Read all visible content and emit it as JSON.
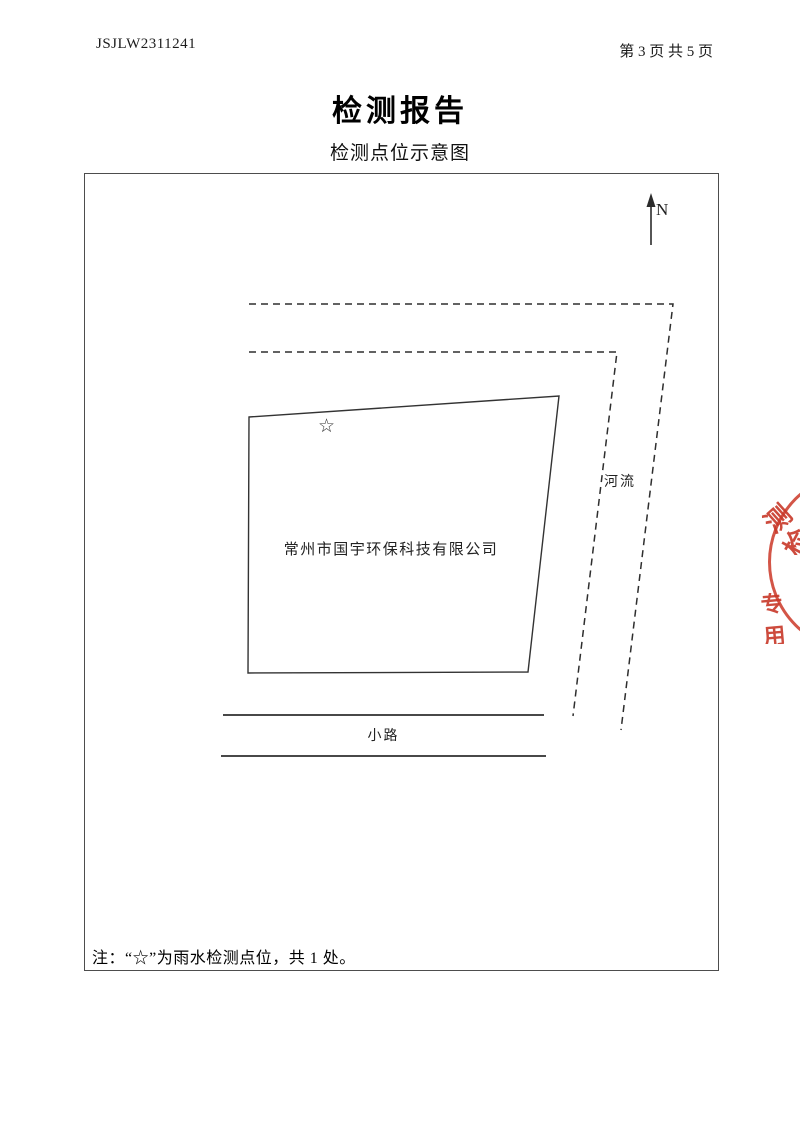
{
  "header": {
    "report_no": "JSJLW2311241",
    "page_info": "第 3 页 共 5 页"
  },
  "title": "检测报告",
  "subtitle": "检测点位示意图",
  "diagram": {
    "north_label": "N",
    "river_label": "河流",
    "site_label": "常州市国宇环保科技有限公司",
    "marker_symbol": "☆",
    "road_label": "小路",
    "note": "注：“☆”为雨水检测点位，共 1 处。"
  },
  "stamp": {
    "ring_chars": [
      "测",
      "检"
    ],
    "center_text": "专用",
    "color": "#cd3e2e"
  }
}
